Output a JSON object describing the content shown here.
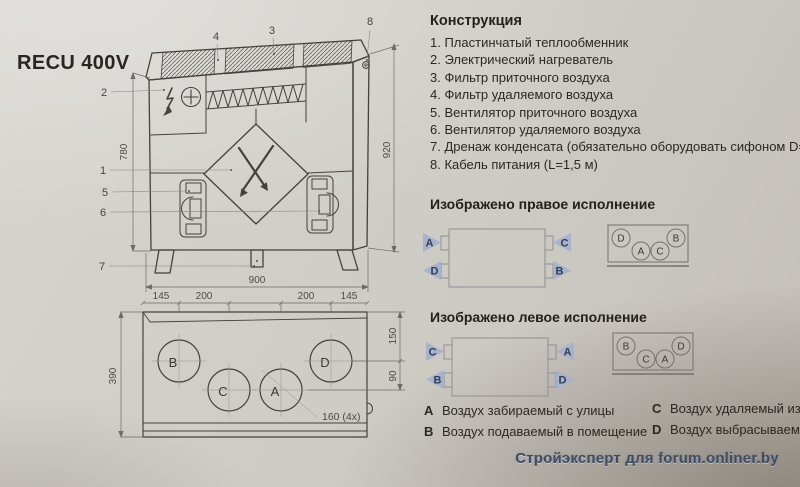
{
  "page": {
    "model": "RECU 400V",
    "watermark": "Стройэксперт для forum.onliner.by"
  },
  "construction": {
    "title": "Конструкция",
    "items": [
      "1. Пластинчатый теплообменник",
      "2. Электрический нагреватель",
      "3. Фильтр приточного воздуха",
      "4. Фильтр удаляемого воздуха",
      "5. Вентилятор приточного воздуха",
      "6. Вентилятор удаляемого воздуха",
      "7. Дренаж конденсата (обязательно оборудовать сифоном D=15 мм",
      "8. Кабель питания (L=1,5 м)"
    ]
  },
  "versions": {
    "right": {
      "title": "Изображено правое исполнение",
      "side": {
        "top_left": "A",
        "bottom_left": "D",
        "top_right": "C",
        "bottom_right": "B"
      },
      "top": {
        "p1": "D",
        "p2": "A",
        "p3": "C",
        "p4": "B"
      }
    },
    "left": {
      "title": "Изображено левое исполнение",
      "side": {
        "top_left": "C",
        "bottom_left": "B",
        "top_right": "A",
        "bottom_right": "D"
      },
      "top": {
        "p1": "B",
        "p2": "C",
        "p3": "A",
        "p4": "D"
      }
    }
  },
  "legend": {
    "a": {
      "key": "A",
      "text": "Воздух забираемый с улицы"
    },
    "b": {
      "key": "B",
      "text": "Воздух подаваемый в помещение"
    },
    "c": {
      "key": "C",
      "text": "Воздух удаляемый из поме"
    },
    "d": {
      "key": "D",
      "text": "Воздух выбрасываемый н"
    }
  },
  "front_view": {
    "callouts": {
      "n1": "1",
      "n2": "2",
      "n3": "3",
      "n4": "4",
      "n5": "5",
      "n6": "6",
      "n7": "7",
      "n8": "8"
    },
    "dim_inner_height": "780",
    "dim_total_height": "920"
  },
  "top_view": {
    "dim_width": "900",
    "dim_seg1": "145",
    "dim_seg2": "200",
    "dim_seg3": "200",
    "dim_seg4": "145",
    "dim_depth": "390",
    "dim_row_top": "150",
    "dim_row_gap": "90",
    "hole_note": "160 (4x)",
    "ports": {
      "b": "B",
      "c": "C",
      "a": "A",
      "d": "D"
    }
  },
  "colors": {
    "triangle_fill": "#a9b2cd",
    "watermark_text": "#3e4b66",
    "drawing_stroke": "#45423d"
  }
}
